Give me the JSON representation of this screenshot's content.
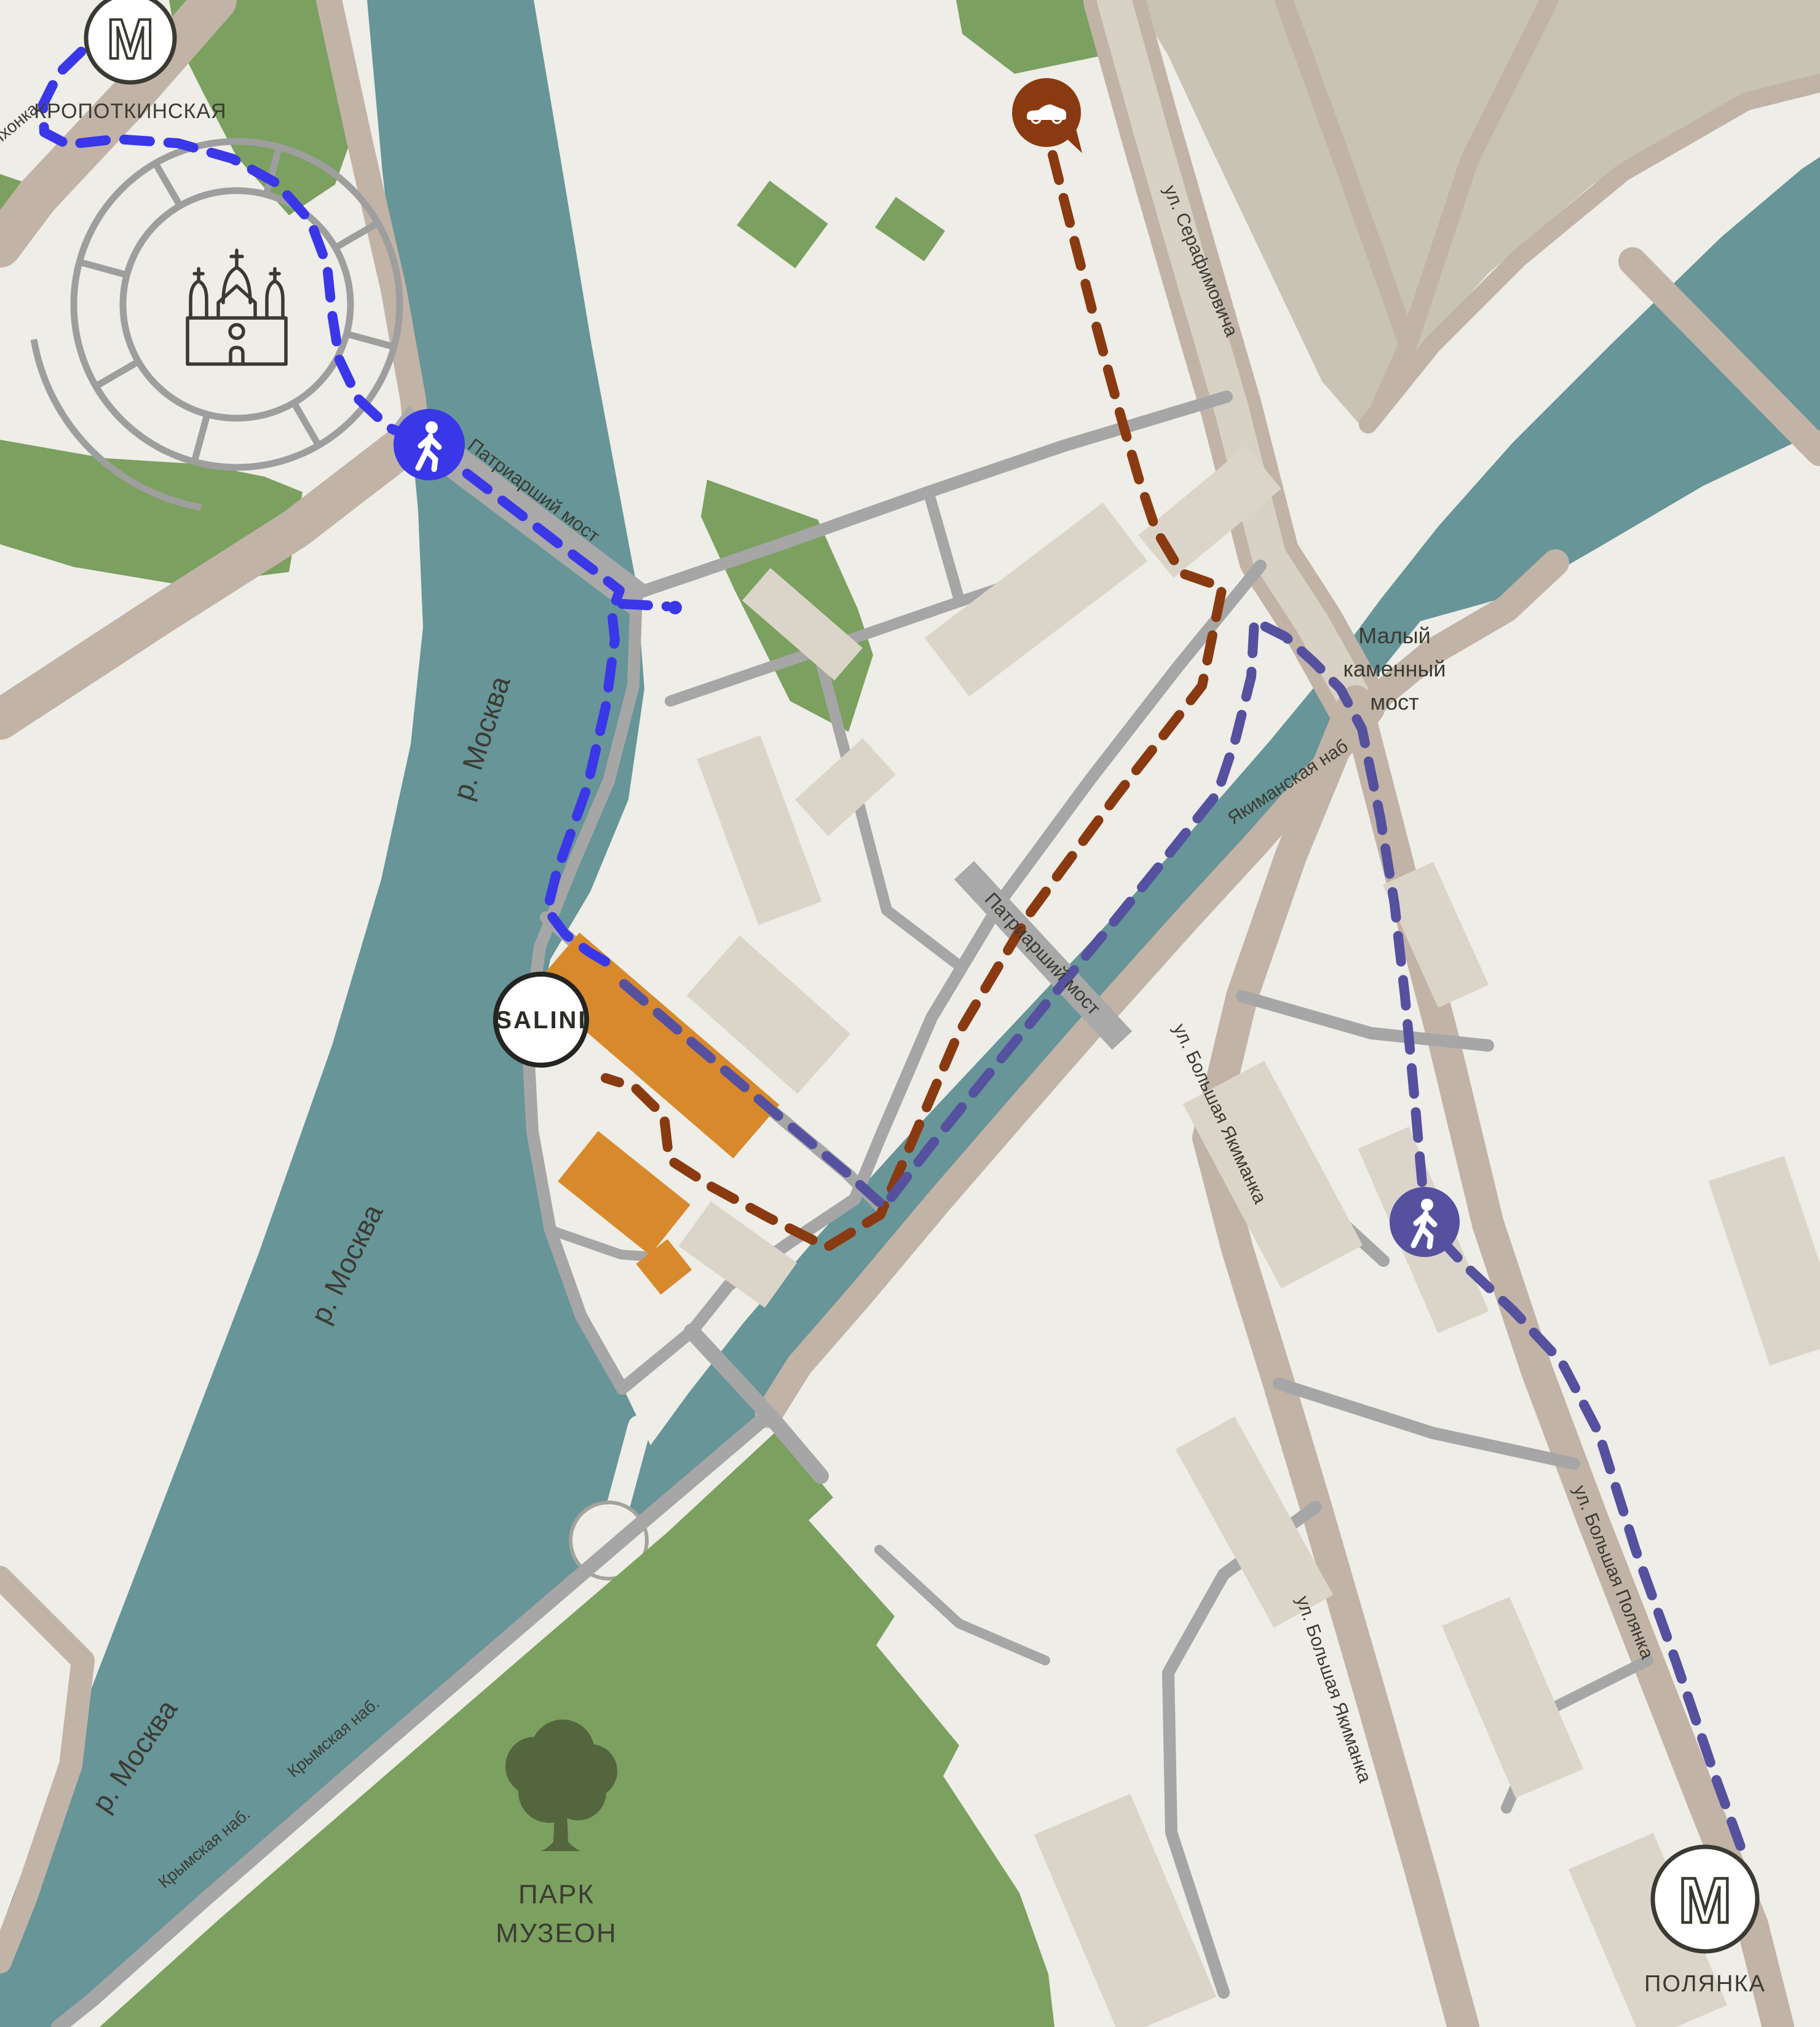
{
  "stations": {
    "kropotkinskaya": {
      "name": "КРОПОТКИНСКАЯ",
      "metro_glyph": "М"
    },
    "polyanka": {
      "name": "ПОЛЯНКА",
      "metro_glyph": "М"
    }
  },
  "destination": {
    "name": "SALINI",
    "color": "#d8892c"
  },
  "river": {
    "name": "р. Москва",
    "color": "#679598"
  },
  "bridges": {
    "patriarshy": "Патриарший мост",
    "maly_kamenny": [
      "Малый",
      "каменный",
      "мост"
    ]
  },
  "streets": {
    "volkhonka": "Волхонка",
    "serafimovicha": "ул. Серафимовича",
    "yakimanskaya_nab": "Якиманская наб",
    "bolshaya_yakimanka": "ул. Большая Якиманка",
    "bolshaya_polyanka": "ул. Большая Полянка",
    "krymskaya_nab": "Крымская наб."
  },
  "park": {
    "name_line1": "ПАРК",
    "name_line2": "МУЗЕОН",
    "color": "#7ca060"
  },
  "routes": {
    "walk_kropotkinskaya": {
      "color": "#3a37e8"
    },
    "walk_polyanka": {
      "color": "#55519f"
    },
    "car": {
      "color": "#8a3a10"
    }
  }
}
